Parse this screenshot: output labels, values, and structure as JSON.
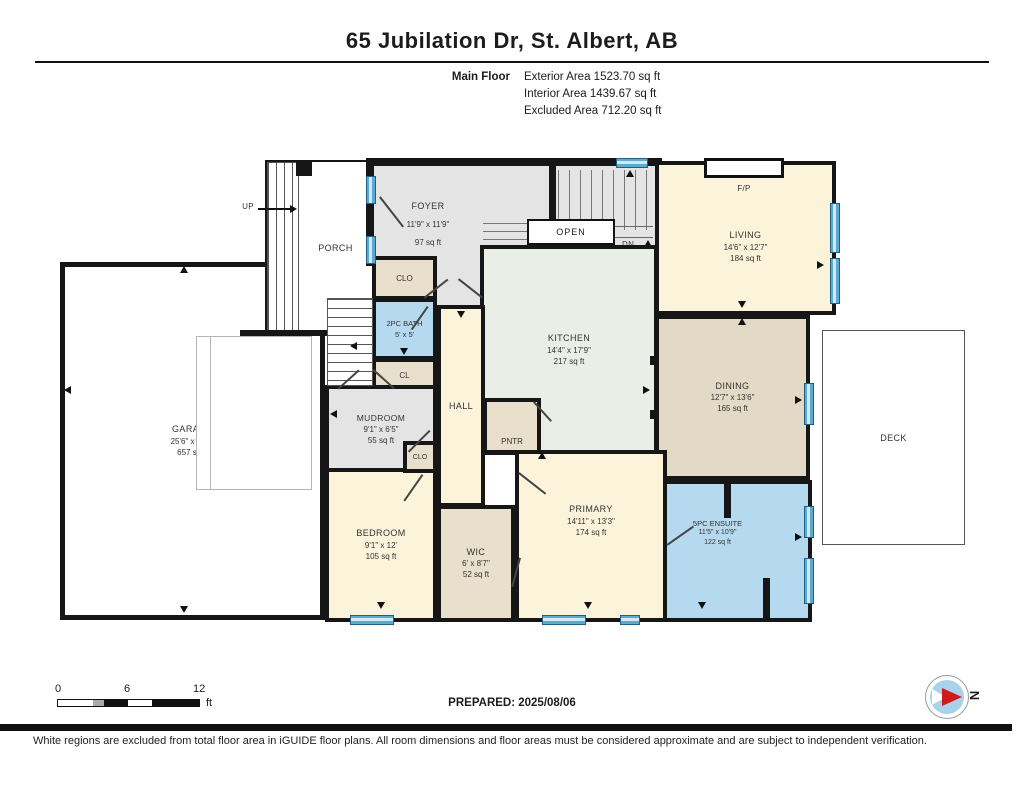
{
  "header": {
    "title": "65 Jubilation Dr, St. Albert, AB",
    "floor_label": "Main Floor",
    "areas": [
      {
        "text": "Exterior Area 1523.70 sq ft"
      },
      {
        "text": "Interior Area 1439.67 sq ft"
      },
      {
        "text": "Excluded Area 712.20 sq ft"
      }
    ]
  },
  "rooms": {
    "foyer": {
      "name": "FOYER",
      "dims": "11'9\" x 11'9\"",
      "area": "97 sq ft"
    },
    "living": {
      "name": "LIVING",
      "dims": "14'6\" x 12'7\"",
      "area": "184 sq ft"
    },
    "kitchen": {
      "name": "KITCHEN",
      "dims": "14'4\" x 17'9\"",
      "area": "217 sq ft"
    },
    "dining": {
      "name": "DINING",
      "dims": "12'7\" x 13'6\"",
      "area": "165 sq ft"
    },
    "garage": {
      "name": "GARAGE",
      "dims": "25'6\" x 29'5\"",
      "area": "657 sq ft"
    },
    "mudroom": {
      "name": "MUDROOM",
      "dims": "9'1\" x 6'5\"",
      "area": "55 sq ft"
    },
    "bath2pc": {
      "name": "2PC BATH",
      "dims": "5' x 5'",
      "area": ""
    },
    "bedroom": {
      "name": "BEDROOM",
      "dims": "9'1\" x 12'",
      "area": "105 sq ft"
    },
    "wic": {
      "name": "WIC",
      "dims": "6' x 8'7\"",
      "area": "52 sq ft"
    },
    "primary": {
      "name": "PRIMARY",
      "dims": "14'11\" x 13'3\"",
      "area": "174 sq ft"
    },
    "ensuite": {
      "name": "5PC ENSUITE",
      "dims": "11'5\" x 10'9\"",
      "area": "122 sq ft"
    }
  },
  "labels": {
    "porch": "PORCH",
    "deck": "DECK",
    "hall": "HALL",
    "pantry": "PNTR",
    "closet_top": "CLO",
    "closet_mid": "CL",
    "closet_bottom": "CLO",
    "open": "OPEN",
    "fireplace": "F/P",
    "up_porch": "UP",
    "up_stairs": "UP",
    "down_stairs": "DN"
  },
  "colors": {
    "wall": "#161616",
    "gray_room": "#e4e4e4",
    "cream_room": "#fbf3da",
    "green_room": "#e9efe7",
    "tan_room": "#e2dac6",
    "tan_light": "#e8dfcc",
    "blue_room": "#b5d9ef",
    "window_blue": "#5ea9cf"
  },
  "footer": {
    "prepared": "PREPARED: 2025/08/06",
    "scale": {
      "tick0": "0",
      "tick6": "6",
      "tick12": "12",
      "unit": "ft"
    },
    "compass_label": "N",
    "disclaimer": "White regions are excluded from total floor area in iGUIDE floor plans. All room dimensions and floor areas must be considered approximate and are subject to independent verification."
  }
}
